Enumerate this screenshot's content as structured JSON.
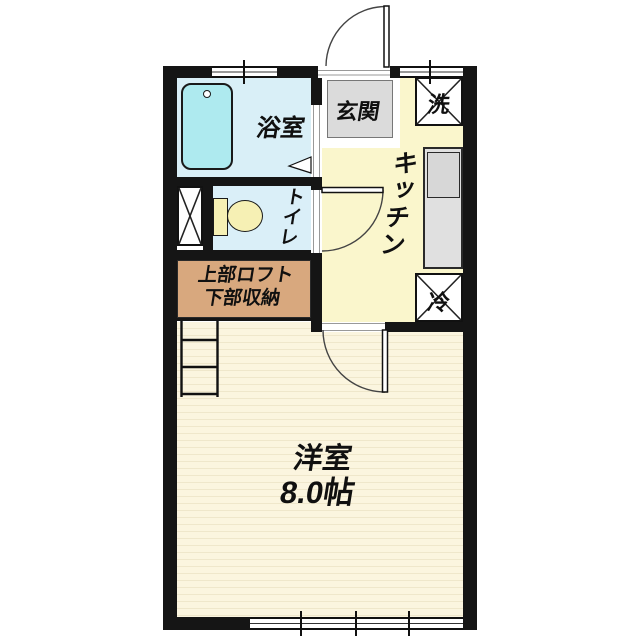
{
  "floorplan": {
    "rooms": {
      "bathroom": {
        "label": "浴室"
      },
      "entrance": {
        "label": "玄関"
      },
      "laundry": {
        "label": "洗"
      },
      "kitchen": {
        "label": "キッチン"
      },
      "refrigerator": {
        "label": "冷"
      },
      "toilet": {
        "label": "トイレ"
      },
      "closet": {
        "label_line1": "上部ロフト",
        "label_line2": "下部収納"
      },
      "western_room": {
        "label": "洋室",
        "area": "8.0帖"
      }
    },
    "colors": {
      "wall": "#151515",
      "bathroom_floor": "#D9EFF7",
      "bathtub": "#AEEAEF",
      "toilet_floor": "#DAEFF8",
      "kitchen_floor": "#FAF6CC",
      "entrance_floor": "#DBDBDB",
      "closet_fill": "#D8A87E",
      "room_floor": "#FBF5DF",
      "room_stripe": "#EFE7CB",
      "counter": "#E0E0E0",
      "fixture_fill": "#F6F0B4"
    }
  }
}
